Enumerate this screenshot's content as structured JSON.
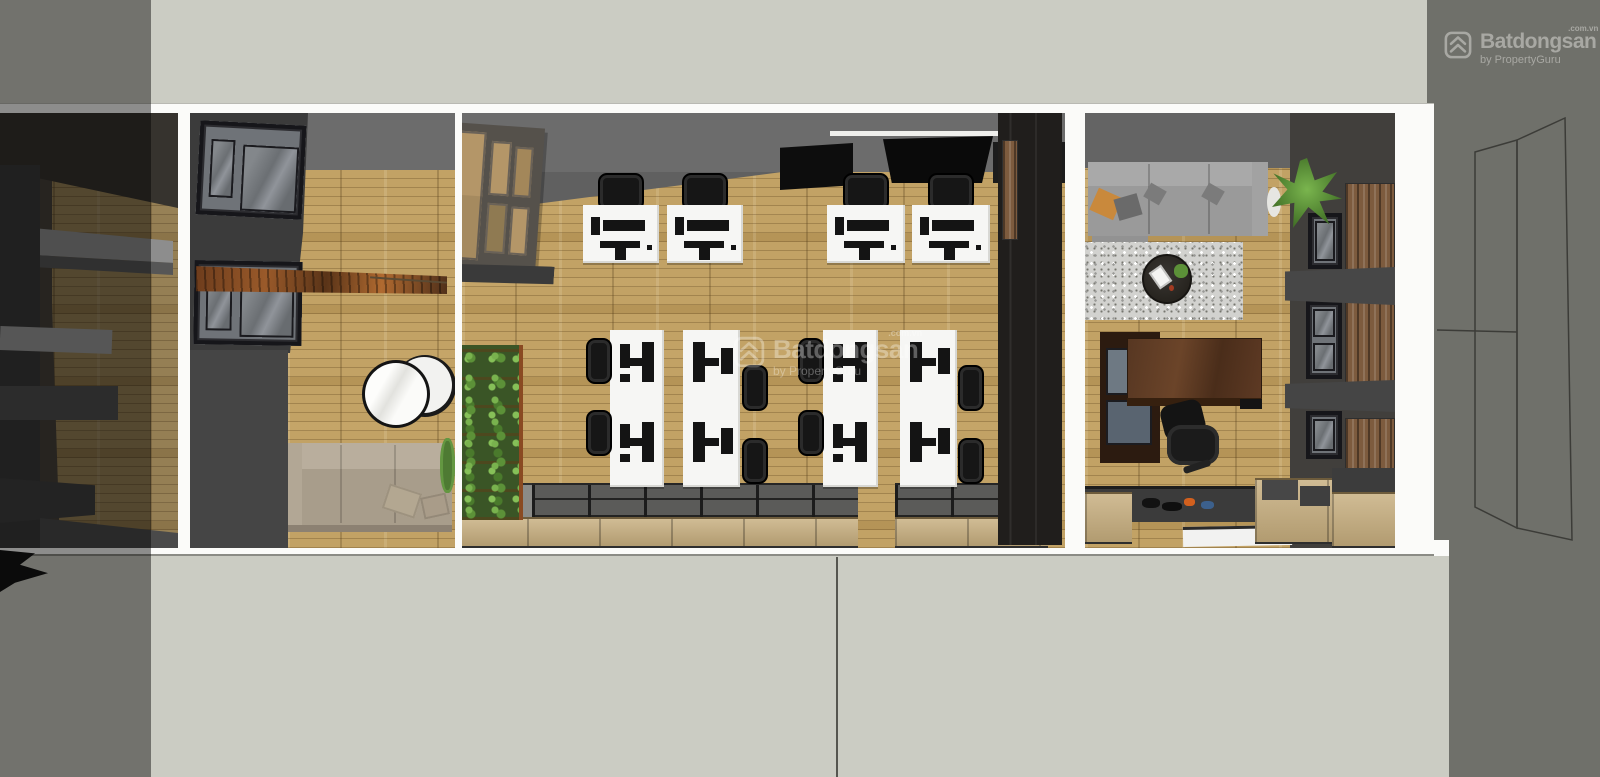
{
  "corner_watermark": {
    "logo_icon": "batdongsan-logo-icon",
    "name": "Batdongsan",
    "domain_suffix": ".com.vn",
    "byline": "by PropertyGuru"
  },
  "center_watermark": {
    "logo_icon": "batdongsan-logo-icon",
    "name": "Batdongsan",
    "domain_suffix": ".com.vn",
    "byline": "by PropertyGuru"
  },
  "palette": {
    "background": "#cbccc3",
    "exterior_ground": "#6f706a",
    "wall_white": "#fbfbf9",
    "wall_dark": "#3c3c3c",
    "wall_gray": "#6c6c6c",
    "wood_floor": "#c2a265",
    "desk_white": "#f6f6f4",
    "chair_black": "#161616",
    "plant_green": "#5c9138",
    "canopy_brown": "#8a4f24",
    "exec_desk_brown": "#573722",
    "sofa_beige": "#a89d8b",
    "sofa_gray": "#9b9b9b",
    "watermark_gray": "#a8a8a3"
  }
}
